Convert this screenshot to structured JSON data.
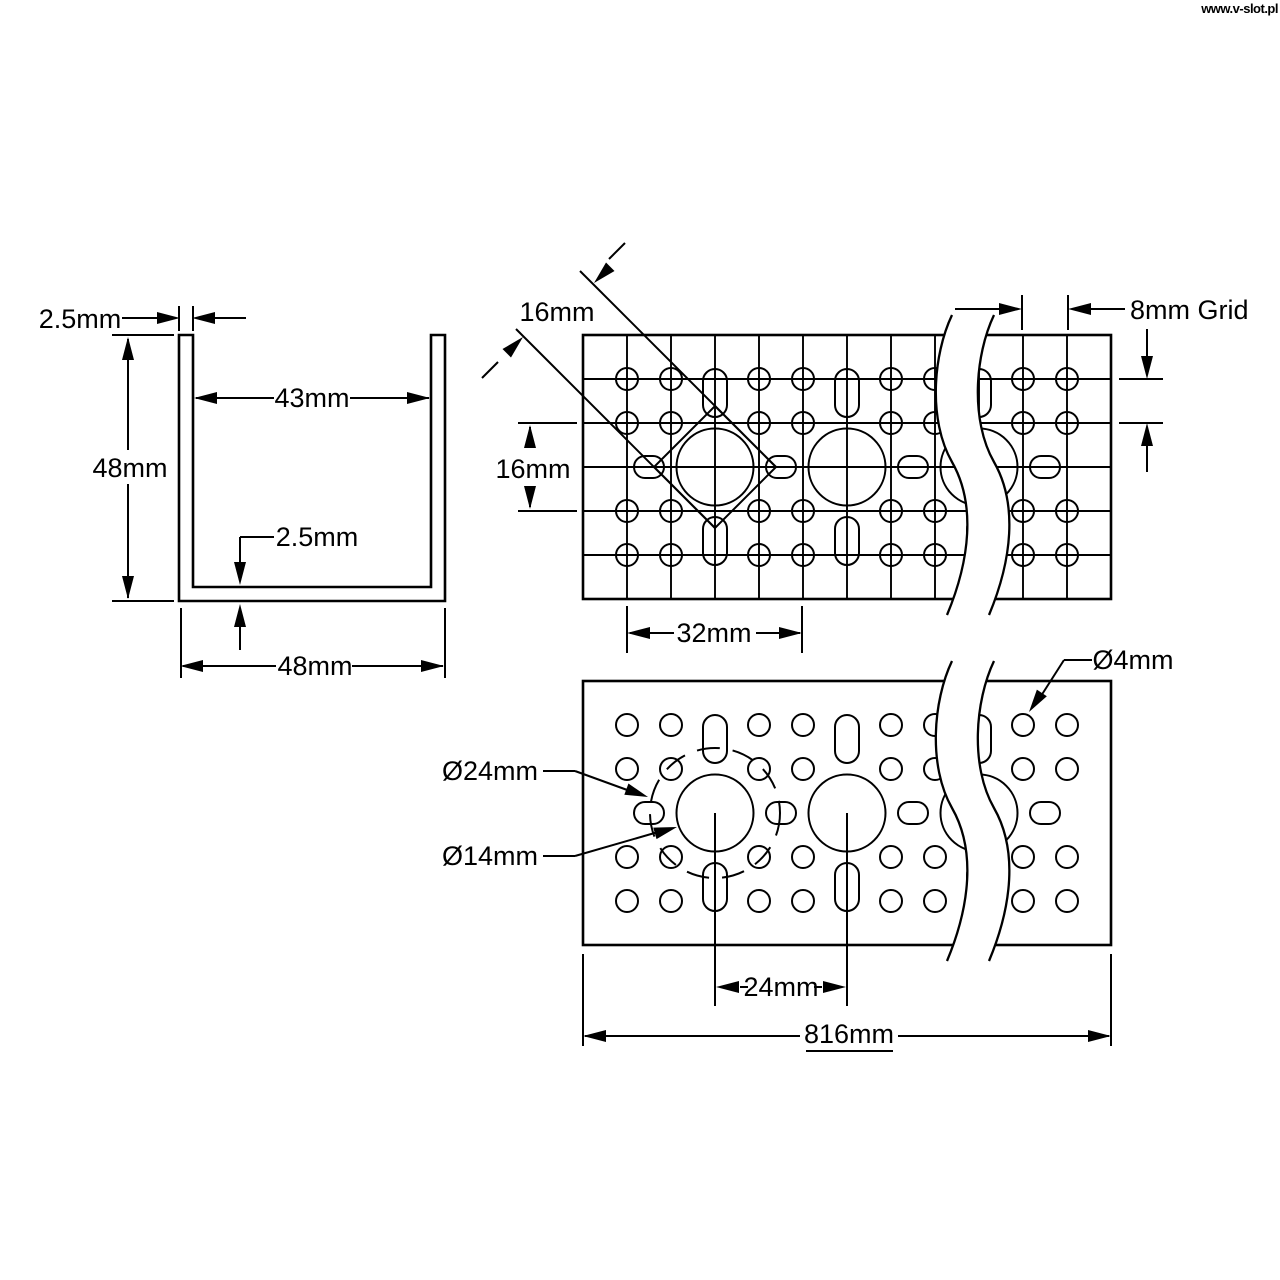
{
  "watermark": "www.v-slot.pl",
  "colors": {
    "line": "#000000",
    "background": "#ffffff"
  },
  "views": {
    "section": {
      "title": "u-channel-cross-section",
      "labels": {
        "wall_thickness": "2.5mm",
        "inner_width": "43mm",
        "height": "48mm",
        "floor_thickness": "2.5mm",
        "outer_width": "48mm"
      }
    },
    "grid_detail": {
      "title": "grid-hole-pattern-detail",
      "labels": {
        "square_pocket": "16mm",
        "row_spacing": "16mm",
        "grid_pitch": "8mm Grid",
        "column_spacing": "32mm"
      }
    },
    "face": {
      "title": "face-hole-pattern",
      "labels": {
        "bolt_circle_dia": "Ø24mm",
        "large_hole_dia": "Ø14mm",
        "small_hole_dia": "Ø4mm",
        "large_hole_spacing": "24mm",
        "overall_length": "816mm"
      }
    }
  }
}
